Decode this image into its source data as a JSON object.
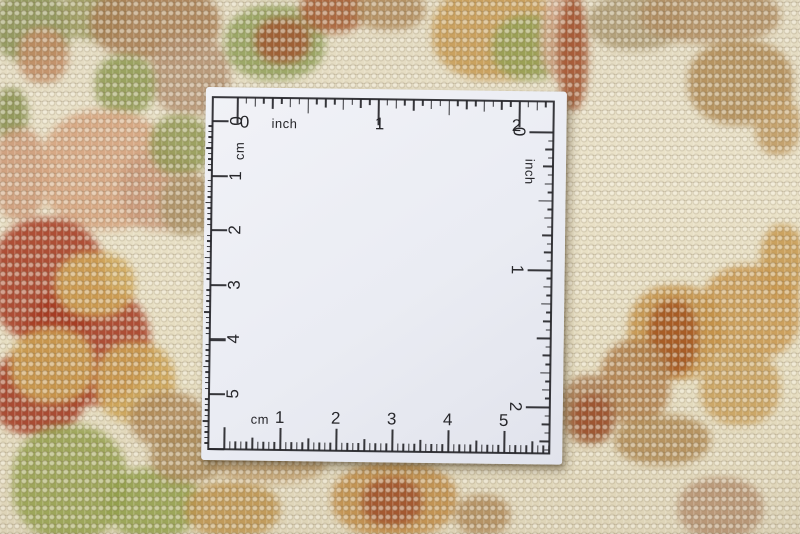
{
  "photo": {
    "subject": "Cream hand-knotted wool rug with red, gold, olive and salmon floral ornament",
    "overlay": "White square measuring card with inch and centimeter scales printed along all four edges",
    "rug_palette": {
      "cream": "#e6ddc2",
      "red": "#a63a22",
      "gold": "#c99850",
      "olive": "#95a04e",
      "salmon": "#d5a27d",
      "tan": "#b08a5a",
      "rust": "#a2512d"
    }
  },
  "ruler_card": {
    "card_color": "#eef0f5",
    "ink_color": "#26262a",
    "top_scale": {
      "unit": "inch",
      "numbers": [
        "0",
        "1",
        "2"
      ]
    },
    "left_scale": {
      "unit": "cm",
      "numbers": [
        "0",
        "1",
        "2",
        "3",
        "4",
        "5"
      ]
    },
    "right_scale": {
      "unit": "inch",
      "numbers": [
        "0",
        "1",
        "2"
      ]
    },
    "bottom_scale": {
      "unit": "cm",
      "numbers": [
        "1",
        "2",
        "3",
        "4",
        "5"
      ]
    }
  }
}
